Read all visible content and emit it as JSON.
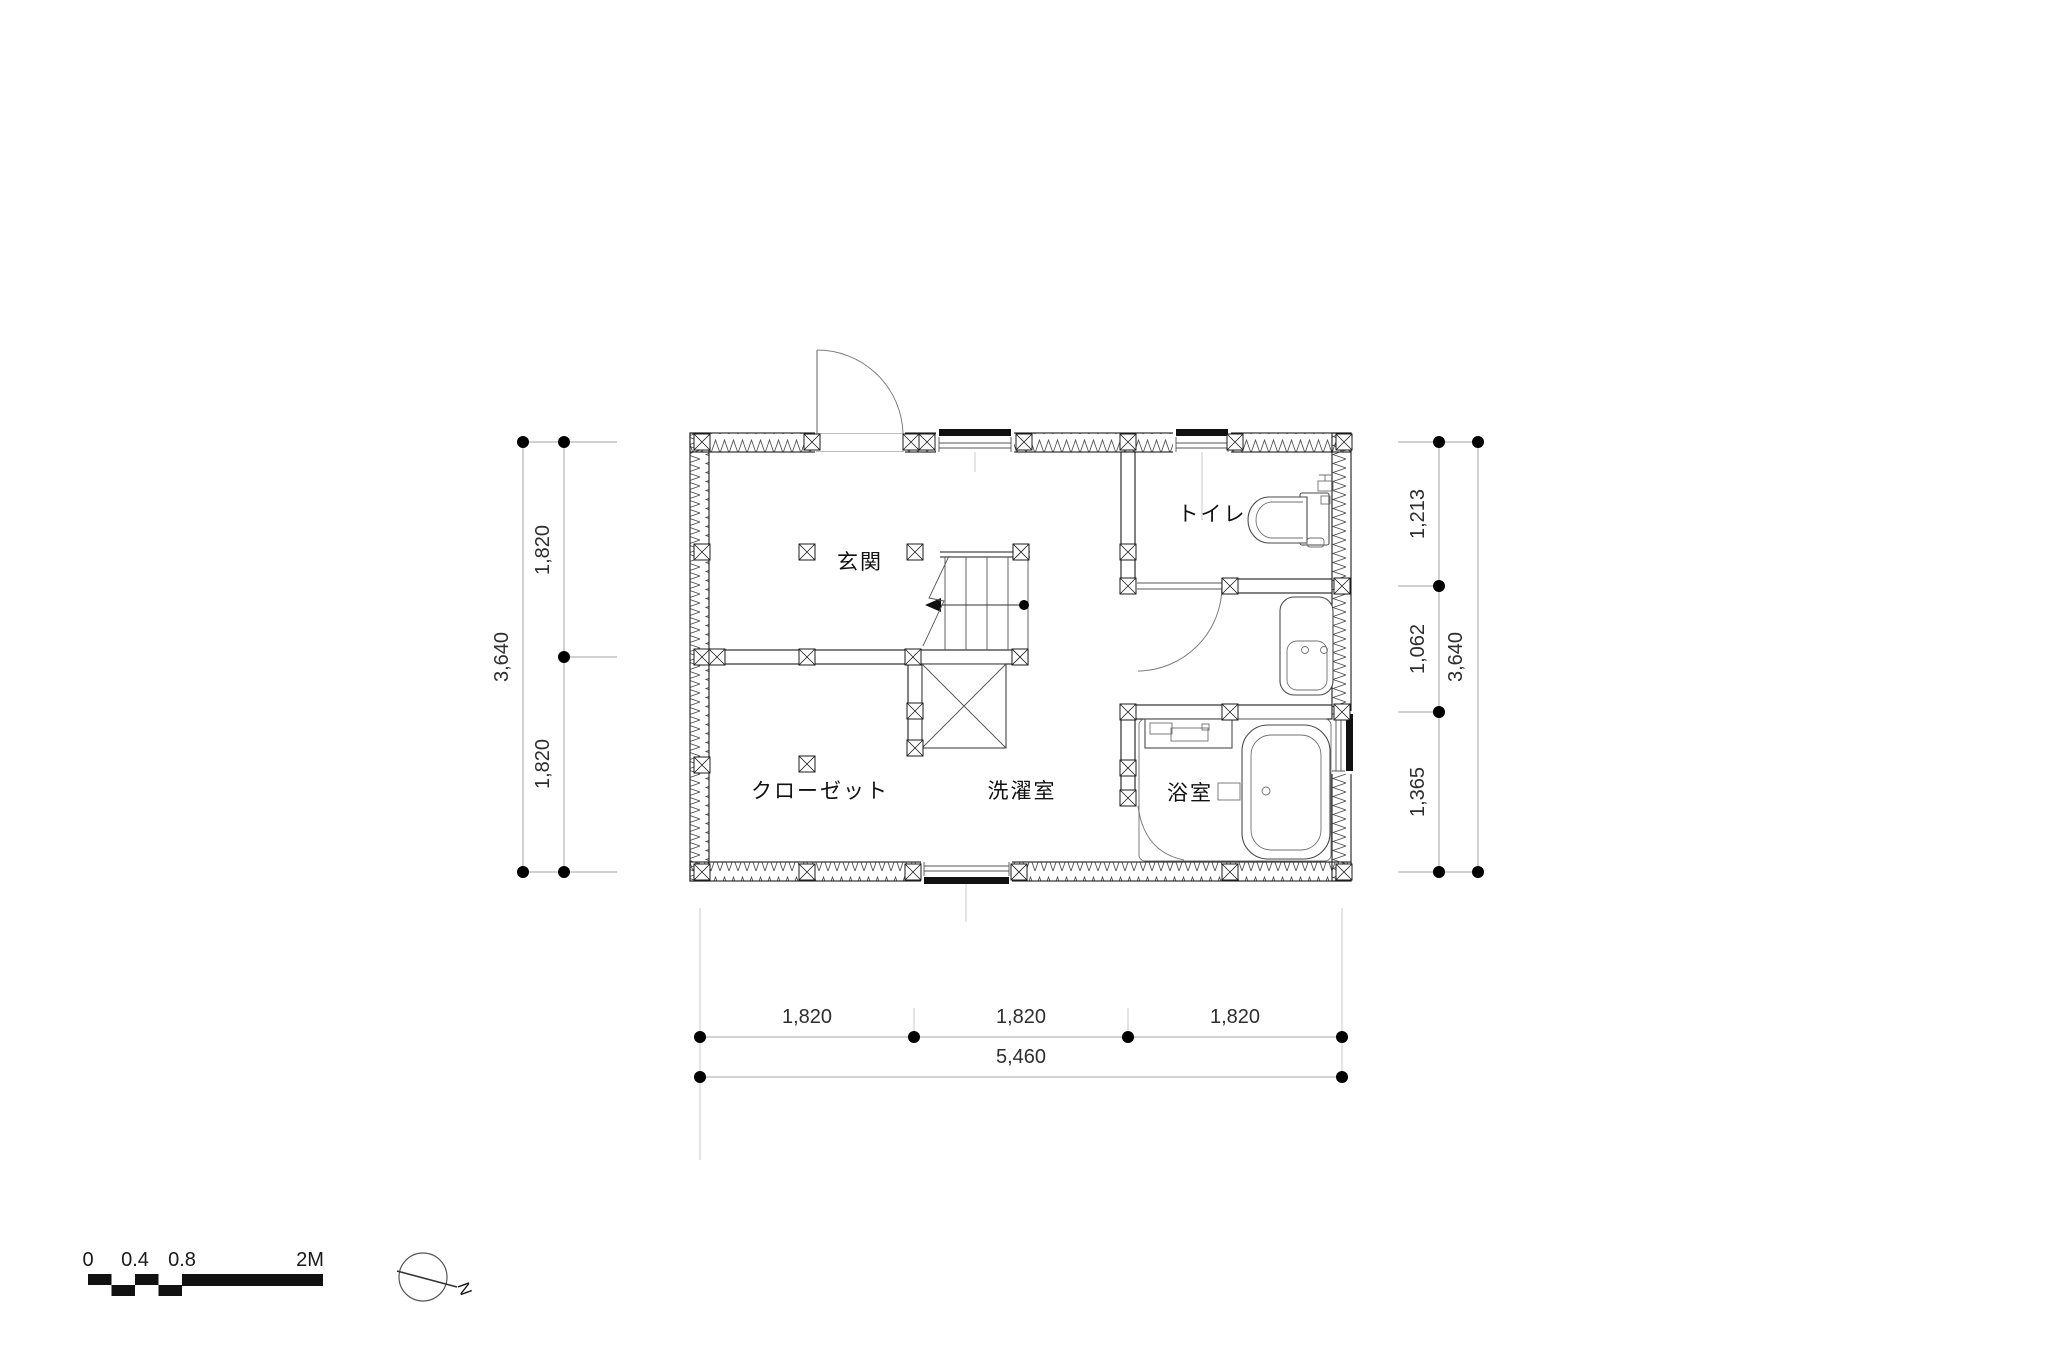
{
  "rooms": {
    "genkan": "玄関",
    "toilet": "トイレ",
    "closet": "クローゼット",
    "laundry": "洗濯室",
    "bath": "浴室"
  },
  "dimensions": {
    "left": {
      "total": "3,640",
      "segments": [
        "1,820",
        "1,820"
      ]
    },
    "right": {
      "total": "3,640",
      "segments": [
        "1,213",
        "1,062",
        "1,365"
      ]
    },
    "bottom": {
      "total": "5,460",
      "segments": [
        "1,820",
        "1,820",
        "1,820"
      ]
    }
  },
  "scale_bar": {
    "ticks": [
      "0",
      "0.4",
      "0.8",
      "2M"
    ]
  },
  "compass": {
    "label": "N"
  },
  "colors": {
    "background": "#ffffff",
    "wall_line": "#1b1b1b",
    "dimension_line": "#a3a3a3",
    "fixture_line": "#4a4a4a",
    "text": "#1a1a1a"
  }
}
